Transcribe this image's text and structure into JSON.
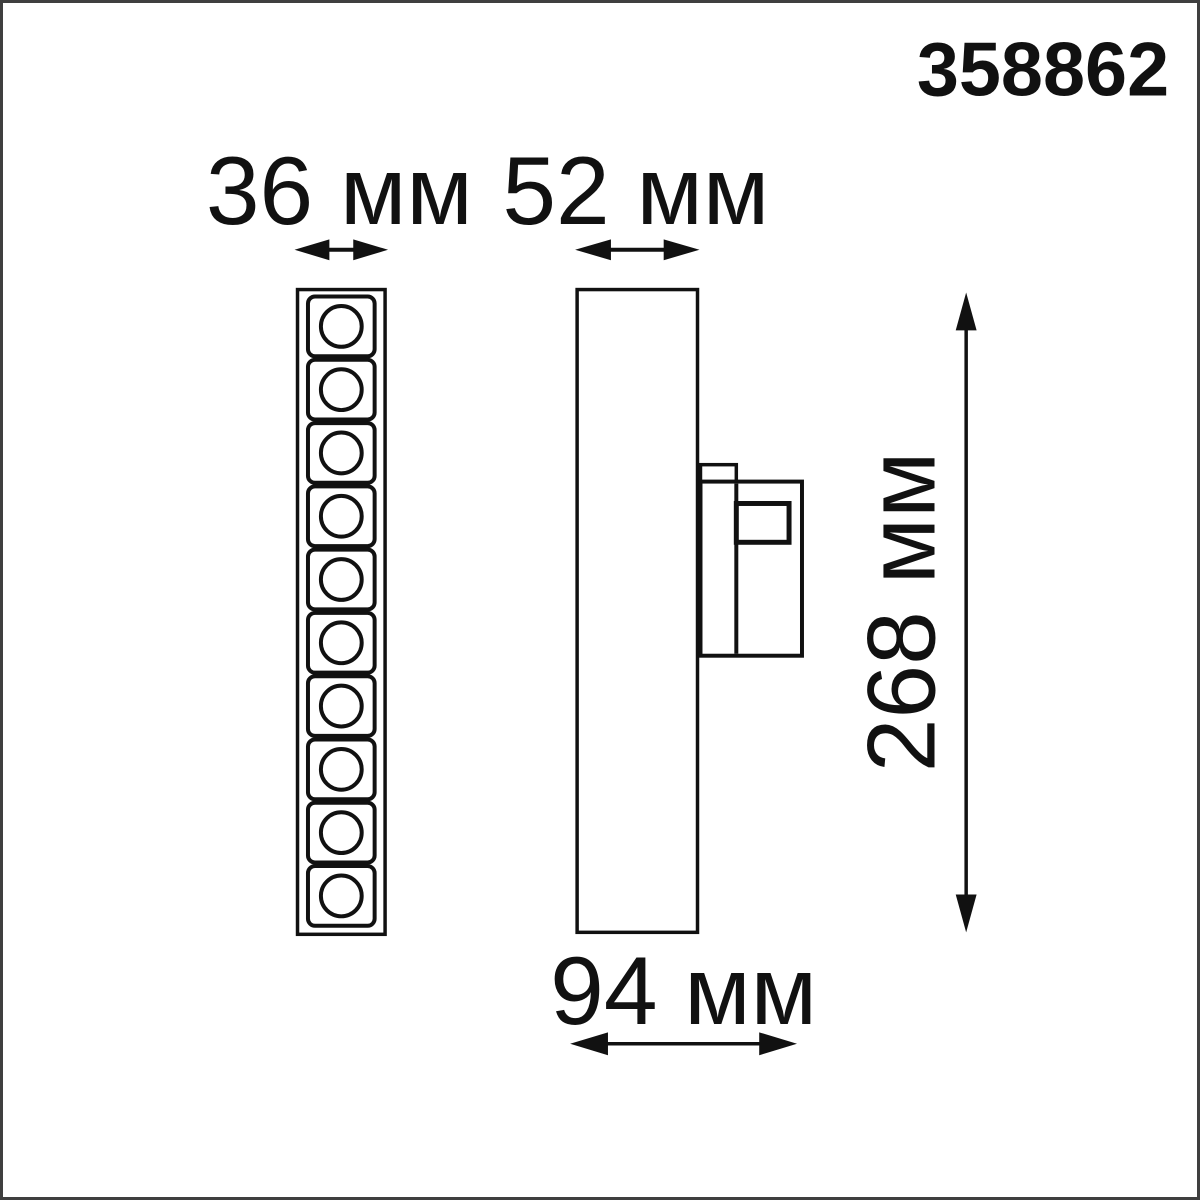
{
  "product_code": "358862",
  "dimensions": {
    "front_width_label": "36 мм",
    "side_width_label": "52 мм",
    "height_label": "268 мм",
    "depth_label": "94 мм"
  },
  "front_view": {
    "led_cell_count": 10
  },
  "colors": {
    "line": "#111111",
    "background": "#ffffff",
    "frame": "#3f3f3f"
  }
}
